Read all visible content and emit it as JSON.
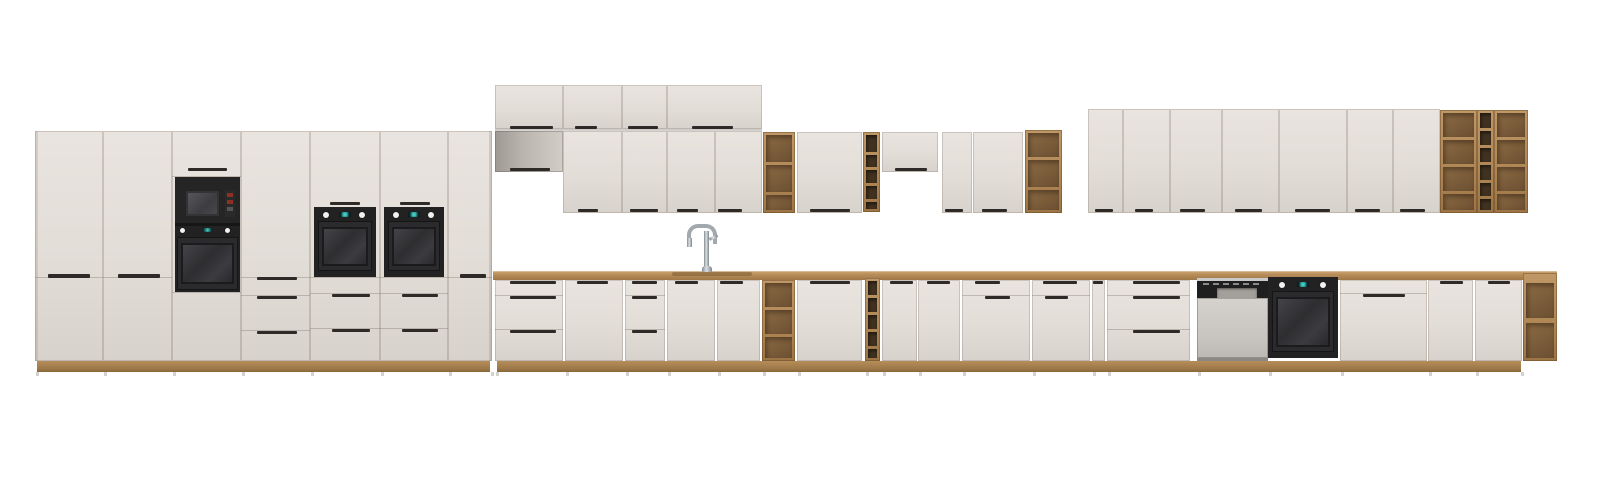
{
  "scene": {
    "width": 1600,
    "height": 482,
    "background": "#ffffff"
  },
  "palette": {
    "front": "#e2ddd7",
    "front_shaded": "#b9b4ae",
    "seam": "#8c7d6f",
    "handle_black": "#2d2a27",
    "oak_frame": "#b28a57",
    "oak_interior": "#7a5c3a",
    "wine_cell": "#41311f",
    "countertop_oak": "#b98f5b",
    "plinth_oak": "#9d7848",
    "appliance_black": "#222222",
    "oven_window": "#3a3a3e",
    "display_teal": "#3fc9c2",
    "knob_white": "#f2f2f0",
    "dishwasher_front": "#cbc8c3",
    "chrome": "#a7adb2",
    "microwave_button_red": "#8c2f25"
  },
  "tall_units": [
    {
      "name": "tall-pantry-cabinet-1",
      "kind": "pantry",
      "x": 35,
      "w": 68,
      "handle": {
        "x": 48,
        "w": 42
      }
    },
    {
      "name": "tall-pantry-cabinet-2",
      "kind": "pantry",
      "x": 103,
      "w": 69,
      "handle": {
        "x": 118,
        "w": 42
      }
    },
    {
      "name": "tall-microwave-oven-tower",
      "kind": "mwtower",
      "x": 172,
      "w": 69
    },
    {
      "name": "tall-cabinet-with-drawers",
      "kind": "talldrawer",
      "x": 241,
      "w": 69,
      "hx": 257,
      "hw": 40
    },
    {
      "name": "tall-oven-tower-1",
      "kind": "oventower",
      "x": 310,
      "w": 70
    },
    {
      "name": "tall-oven-tower-2",
      "kind": "oventower",
      "x": 380,
      "w": 68
    },
    {
      "name": "tall-pantry-cabinet-3",
      "kind": "pantry",
      "x": 448,
      "w": 44,
      "handle": {
        "x": 460,
        "w": 26
      }
    }
  ],
  "top_boxes": [
    {
      "name": "wall-top-box-1",
      "x": 495,
      "w": 68,
      "handle": {
        "x": 510,
        "w": 43
      }
    },
    {
      "name": "wall-top-box-2",
      "x": 563,
      "w": 59,
      "handle": {
        "x": 575,
        "w": 22
      }
    },
    {
      "name": "wall-top-box-3",
      "x": 622,
      "w": 45,
      "handle": {
        "x": 628,
        "w": 30
      }
    },
    {
      "name": "wall-top-box-4",
      "x": 667,
      "w": 95,
      "handle": {
        "x": 692,
        "w": 41
      }
    }
  ],
  "wall_units": [
    {
      "name": "wall-short-cabinet-1",
      "kind": "short",
      "x": 495,
      "w": 68,
      "y": 131,
      "h": 41,
      "dark": true,
      "handle": {
        "x": 510,
        "w": 40
      }
    },
    {
      "name": "wall-cabinet-1",
      "kind": "door",
      "x": 563,
      "w": 59,
      "y": 131,
      "h": 82,
      "handle": {
        "x": 578,
        "w": 20
      }
    },
    {
      "name": "wall-cabinet-2",
      "kind": "door",
      "x": 622,
      "w": 45,
      "y": 131,
      "h": 82,
      "handle": {
        "x": 630,
        "w": 28
      }
    },
    {
      "name": "wall-cabinet-3",
      "kind": "door",
      "x": 667,
      "w": 48,
      "y": 131,
      "h": 82,
      "handle": {
        "x": 677,
        "w": 21
      }
    },
    {
      "name": "wall-cabinet-4",
      "kind": "door",
      "x": 715,
      "w": 47,
      "y": 131,
      "h": 82,
      "handle": {
        "x": 718,
        "w": 24
      }
    },
    {
      "name": "wall-open-shelf-1",
      "kind": "shelf",
      "x": 763,
      "w": 32,
      "y": 132,
      "h": 81,
      "shelves": [
        162,
        192
      ]
    },
    {
      "name": "wall-cabinet-5",
      "kind": "door",
      "x": 797,
      "w": 65,
      "y": 132,
      "h": 81,
      "handle": {
        "x": 810,
        "w": 40
      }
    },
    {
      "name": "wall-wine-rack",
      "kind": "wine",
      "x": 863,
      "w": 17,
      "y": 132,
      "h": 80,
      "lines": [
        152,
        167,
        183,
        199
      ]
    },
    {
      "name": "wall-short-cabinet-2",
      "kind": "short",
      "x": 882,
      "w": 56,
      "y": 132,
      "h": 40,
      "handle": {
        "x": 895,
        "w": 32
      }
    },
    {
      "name": "wall-cabinet-6",
      "kind": "door",
      "x": 942,
      "w": 30,
      "y": 132,
      "h": 81,
      "handle": {
        "x": 945,
        "w": 18
      }
    },
    {
      "name": "wall-cabinet-7",
      "kind": "door",
      "x": 973,
      "w": 50,
      "y": 132,
      "h": 81,
      "handle": {
        "x": 982,
        "w": 25
      }
    },
    {
      "name": "wall-open-shelf-2",
      "kind": "shelf",
      "x": 1025,
      "w": 37,
      "y": 130,
      "h": 83,
      "shelves": [
        157,
        187
      ]
    },
    {
      "name": "wall-cabinet-8",
      "kind": "door",
      "x": 1088,
      "w": 35,
      "y": 109,
      "h": 104,
      "handle": {
        "x": 1095,
        "w": 18
      }
    },
    {
      "name": "wall-cabinet-9",
      "kind": "door",
      "x": 1123,
      "w": 47,
      "y": 109,
      "h": 104,
      "handle": {
        "x": 1135,
        "w": 18
      }
    },
    {
      "name": "wall-cabinet-10",
      "kind": "door",
      "x": 1170,
      "w": 52,
      "y": 109,
      "h": 104,
      "handle": {
        "x": 1180,
        "w": 25
      }
    },
    {
      "name": "wall-cabinet-11",
      "kind": "door",
      "x": 1222,
      "w": 57,
      "y": 109,
      "h": 104,
      "handle": {
        "x": 1235,
        "w": 27
      }
    },
    {
      "name": "wall-cabinet-12",
      "kind": "door",
      "x": 1279,
      "w": 68,
      "y": 109,
      "h": 104,
      "handle": {
        "x": 1295,
        "w": 35
      }
    },
    {
      "name": "wall-cabinet-13",
      "kind": "door",
      "x": 1347,
      "w": 46,
      "y": 109,
      "h": 104,
      "handle": {
        "x": 1355,
        "w": 25
      }
    },
    {
      "name": "wall-cabinet-14",
      "kind": "door",
      "x": 1393,
      "w": 47,
      "y": 109,
      "h": 104,
      "handle": {
        "x": 1400,
        "w": 25
      }
    },
    {
      "name": "wall-shelf-wine-combo",
      "kind": "combo",
      "x": 1440,
      "w": 88,
      "y": 110,
      "h": 103,
      "cols": [
        {
          "w": 37,
          "shelves": [
            137,
            164,
            191
          ]
        },
        {
          "w": 17,
          "lines": [
            128,
            145,
            162,
            180,
            196
          ],
          "wine": true
        },
        {
          "w": 34,
          "shelves": [
            137,
            164,
            191
          ]
        }
      ]
    }
  ],
  "base_units": [
    {
      "name": "base-drawer-unit-1",
      "kind": "drawers3",
      "x": 495,
      "w": 68,
      "hx": 510,
      "hw": 46
    },
    {
      "name": "base-cabinet-1",
      "kind": "door",
      "x": 565,
      "w": 58,
      "hx": 577,
      "hw": 31
    },
    {
      "name": "base-drawer-unit-2",
      "kind": "drawers3",
      "x": 625,
      "w": 40,
      "hx": 632,
      "hw": 25
    },
    {
      "name": "sink-cabinet-door-left",
      "kind": "door",
      "x": 667,
      "w": 48,
      "hx": 675,
      "hw": 23
    },
    {
      "name": "sink-cabinet-door-right",
      "kind": "door",
      "x": 717,
      "w": 43,
      "hx": 720,
      "hw": 23
    },
    {
      "name": "base-open-shelf",
      "kind": "shelf",
      "x": 762,
      "w": 33,
      "shelves": [
        307,
        334
      ]
    },
    {
      "name": "base-cabinet-2",
      "kind": "door",
      "x": 797,
      "w": 65,
      "hx": 810,
      "hw": 40
    },
    {
      "name": "base-wine-rack",
      "kind": "wine",
      "x": 865,
      "w": 15,
      "lines": [
        295,
        312,
        329,
        346
      ]
    },
    {
      "name": "base-cabinet-3",
      "kind": "door",
      "x": 882,
      "w": 35,
      "hx": 890,
      "hw": 23
    },
    {
      "name": "base-cabinet-4",
      "kind": "door",
      "x": 918,
      "w": 42,
      "hx": 927,
      "hw": 23
    },
    {
      "name": "base-drawer-door-unit-1",
      "kind": "drawerdoor",
      "x": 962,
      "w": 68,
      "top": {
        "x": 975,
        "w": 25
      },
      "mid": {
        "x": 985,
        "w": 25
      }
    },
    {
      "name": "base-drawer-door-unit-2",
      "kind": "drawerdoor",
      "x": 1032,
      "w": 58,
      "top": {
        "x": 1043,
        "w": 34
      },
      "mid": {
        "x": 1045,
        "w": 23
      }
    },
    {
      "name": "base-narrow-cabinet",
      "kind": "door",
      "x": 1092,
      "w": 13,
      "hx": 1093,
      "hw": 10
    },
    {
      "name": "base-drawer-unit-3",
      "kind": "drawers3",
      "x": 1107,
      "w": 83,
      "hx": 1133,
      "hw": 47
    },
    {
      "name": "dishwasher",
      "kind": "dishwasher",
      "x": 1197,
      "w": 71
    },
    {
      "name": "built-in-oven",
      "kind": "baseoven",
      "x": 1268,
      "w": 70
    },
    {
      "name": "base-panel-door-unit",
      "kind": "paneldoor",
      "x": 1340,
      "w": 87,
      "mid": {
        "x": 1363,
        "w": 42
      }
    },
    {
      "name": "base-cabinet-5",
      "kind": "door",
      "x": 1428,
      "w": 45,
      "hx": 1440,
      "hw": 23
    },
    {
      "name": "base-cabinet-6",
      "kind": "door",
      "x": 1475,
      "w": 47,
      "hx": 1488,
      "hw": 22
    },
    {
      "name": "base-end-open-shelf",
      "kind": "endshelf",
      "x": 1523,
      "w": 34,
      "shelf": 320
    }
  ],
  "fixtures": {
    "countertop": {
      "x": 493,
      "w": 1064,
      "y": 271,
      "h": 9
    },
    "sink_inset": {
      "x": 672,
      "w": 80,
      "y": 272,
      "h": 4
    },
    "faucet": {
      "x": 687,
      "y": 224
    },
    "plinth_tall": {
      "x": 37,
      "w": 453,
      "y": 361,
      "h": 11
    },
    "plinth_base": {
      "x": 497,
      "w": 1024,
      "y": 361,
      "h": 11
    }
  }
}
